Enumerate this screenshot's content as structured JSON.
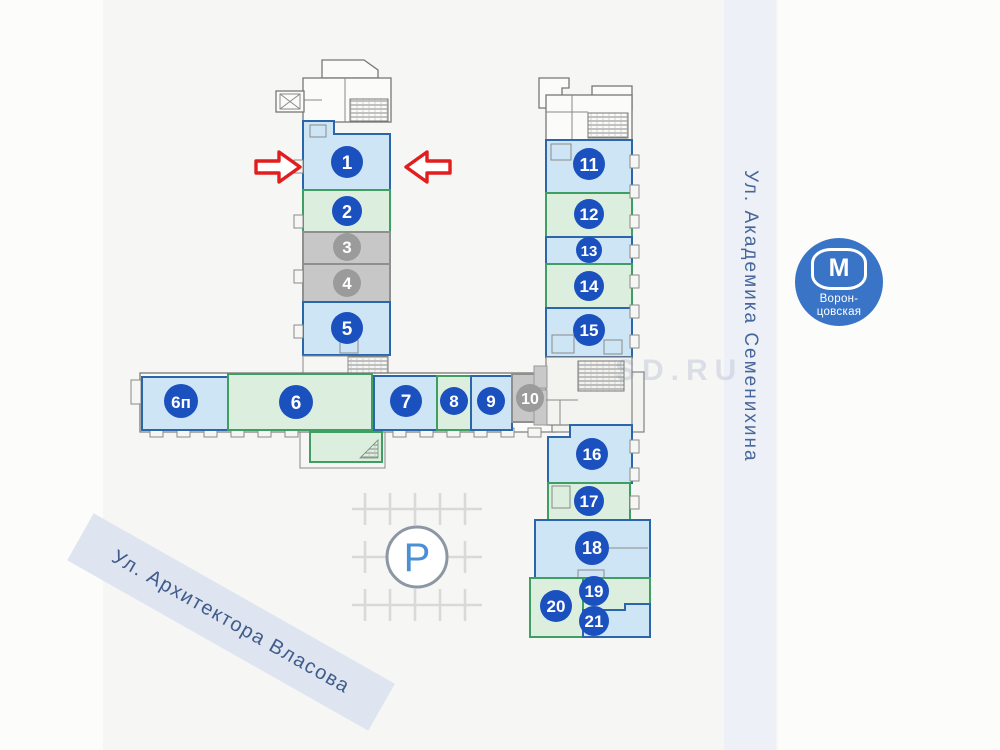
{
  "units": [
    {
      "label": "1",
      "color": "blue"
    },
    {
      "label": "2",
      "color": "green"
    },
    {
      "label": "3",
      "color": "gray"
    },
    {
      "label": "4",
      "color": "gray"
    },
    {
      "label": "5",
      "color": "blue"
    },
    {
      "label": "6п",
      "color": "blue"
    },
    {
      "label": "6",
      "color": "green"
    },
    {
      "label": "7",
      "color": "blue"
    },
    {
      "label": "8",
      "color": "green"
    },
    {
      "label": "9",
      "color": "blue"
    },
    {
      "label": "10",
      "color": "gray"
    },
    {
      "label": "11",
      "color": "blue"
    },
    {
      "label": "12",
      "color": "green"
    },
    {
      "label": "13",
      "color": "blue"
    },
    {
      "label": "14",
      "color": "green"
    },
    {
      "label": "15",
      "color": "blue"
    },
    {
      "label": "16",
      "color": "blue"
    },
    {
      "label": "17",
      "color": "green"
    },
    {
      "label": "18",
      "color": "blue"
    },
    {
      "label": "19",
      "color": "green"
    },
    {
      "label": "20",
      "color": "green"
    },
    {
      "label": "21",
      "color": "blue"
    }
  ],
  "streets": {
    "bottom_left": "Ул. Архитектора Власова",
    "right": "Ул. Академика Семенихина"
  },
  "metro": {
    "letter": "М",
    "name_line1": "Ворон-",
    "name_line2": "цовская",
    "color": "#3a74c7"
  },
  "parking": {
    "symbol": "P"
  },
  "watermark": "SD.RU",
  "arrows": {
    "color": "#e21d1d",
    "points_at_unit": "1"
  },
  "colors": {
    "unit_blue_fill": "#cde5f4",
    "unit_blue_border": "#2b66ab",
    "unit_green_fill": "#dcefdf",
    "unit_green_border": "#3f9f63",
    "unit_gray_fill": "#c7c7c7",
    "unit_gray_border": "#8f8f8f",
    "number_badge_blue": "#1b50bf",
    "number_badge_gray": "#9b9b9b",
    "background": "#f6f6f4"
  }
}
